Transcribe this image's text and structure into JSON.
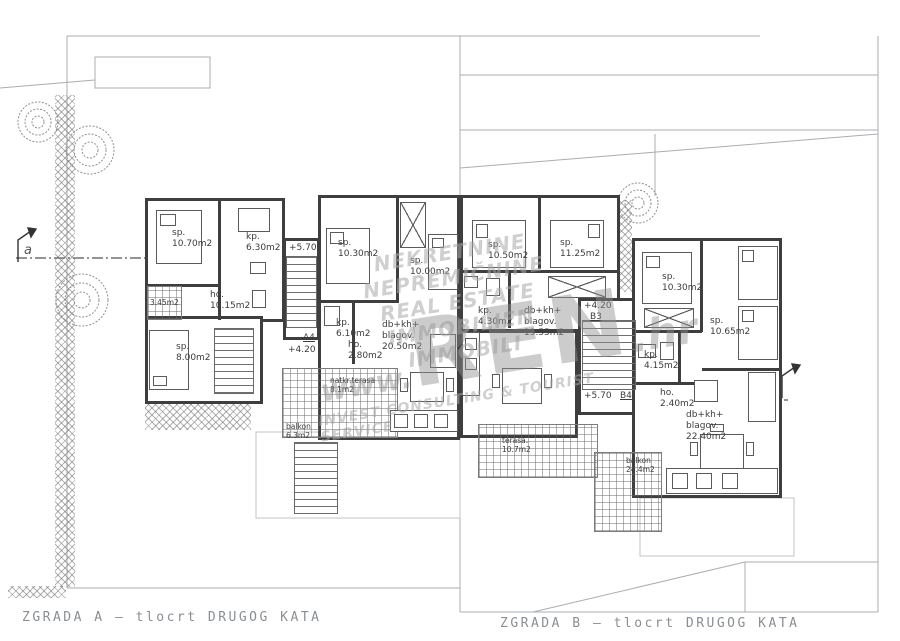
{
  "drawing": {
    "title_a": "ZGRADA A — tlocrt DRUGOG KATA",
    "title_b": "ZGRADA B — tlocrt DRUGOG KATA",
    "section_marker_left": "a",
    "section_marker_right": "a"
  },
  "watermark": {
    "lines": [
      "NEKRETNINE",
      "NEPREMIČNINE",
      "REAL ESTATE",
      "IMMOBILIEN",
      "IMMOBILI"
    ],
    "www": "www.",
    "ren": "REN",
    "hr": ".hr",
    "tagline": "INVEST CONSULTING & TOURIST SERVICE"
  },
  "building_a": {
    "unit1": {
      "sp1": "sp.\n10.70m2",
      "kp": "kp.\n6.30m2",
      "ho": "ho.\n10.15m2",
      "sp2": "sp.\n8.00m2",
      "loggia": "3.45m2"
    },
    "stair": {
      "elev_top": "+5.70",
      "unit_label": "A4",
      "elev_bottom": "+4.20"
    },
    "unit2": {
      "sp1": "sp.\n10.30m2",
      "sp2": "sp.\n10.00m2",
      "kp": "kp.\n6.10m2",
      "ho": "ho.\n2.80m2",
      "living": "db+kh+\nblagov.\n20.50m2",
      "terrace": "natkr.terasa\n8.1m2",
      "balcony": "balkon\n6.3m2"
    }
  },
  "building_b": {
    "unit3": {
      "sp1": "sp.\n10.50m2",
      "sp2": "sp.\n11.25m2",
      "kp": "kp.\n4.30m2",
      "living": "db+kh+\nblagov.\n19.55m2",
      "terrace": "terasa.\n10.7m2"
    },
    "stair": {
      "elev_top": "+4.20",
      "unit_top": "B3",
      "elev_bottom": "+5.70",
      "unit_bottom": "B4"
    },
    "unit4": {
      "sp1": "sp.\n10.30m2",
      "sp2": "sp.\n10.65m2",
      "kp": "kp.\n4.15m2",
      "ho": "ho.\n2.40m2",
      "living": "db+kh+\nblagov.\n22.40m2",
      "balcony": "balkon\n24.4m2"
    }
  }
}
